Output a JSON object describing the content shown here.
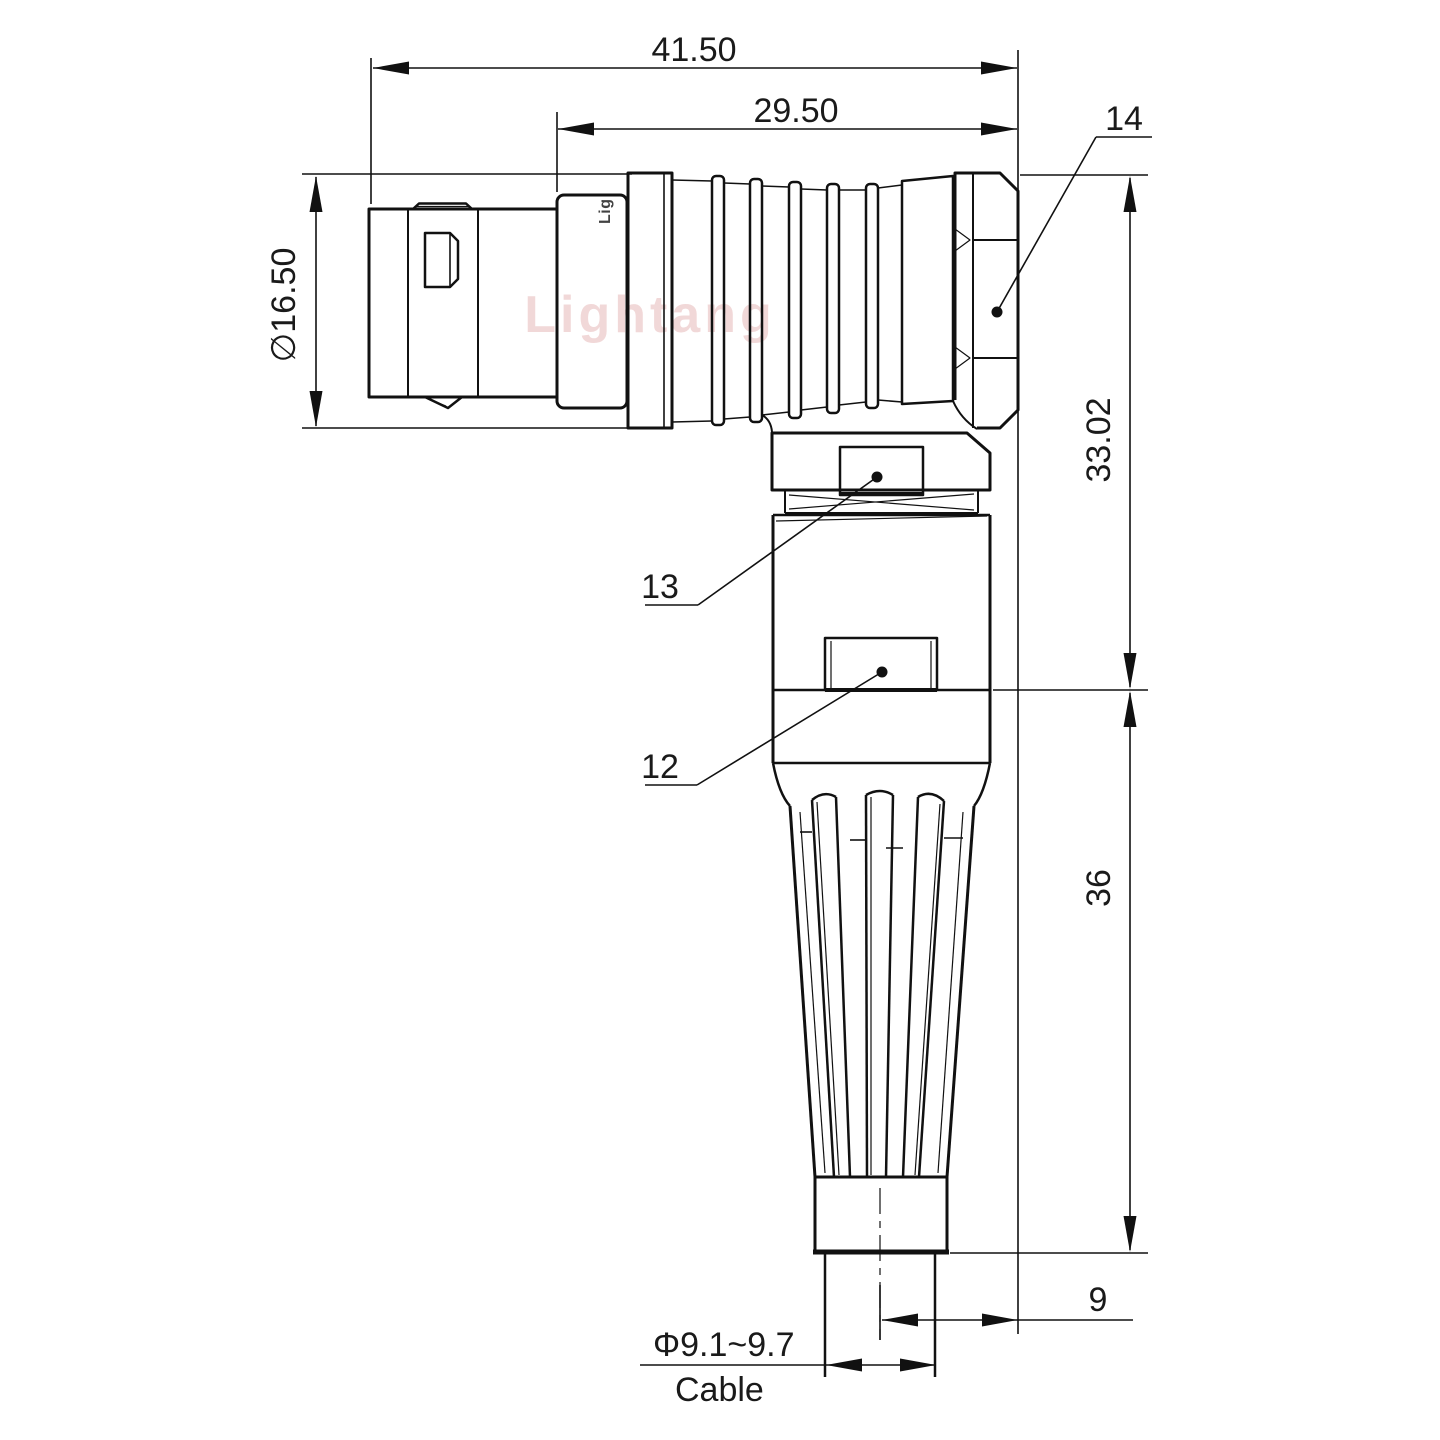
{
  "drawing": {
    "dimensions": {
      "overall_length": "41.50",
      "rear_length": "29.50",
      "shell_diameter": "∅16.50",
      "height_upper": "33.02",
      "height_lower": "36",
      "cable_offset": "9",
      "cable_diameter": "Φ9.1~9.7",
      "cable_label": "Cable"
    },
    "callouts": {
      "item_14": "14",
      "item_13": "13",
      "item_12": "12"
    },
    "watermark": "Lightang",
    "sleeve_logo": "Lig",
    "colors": {
      "line": "#111111",
      "text": "#1a1a1a",
      "watermark": "#dd9a9a"
    }
  }
}
